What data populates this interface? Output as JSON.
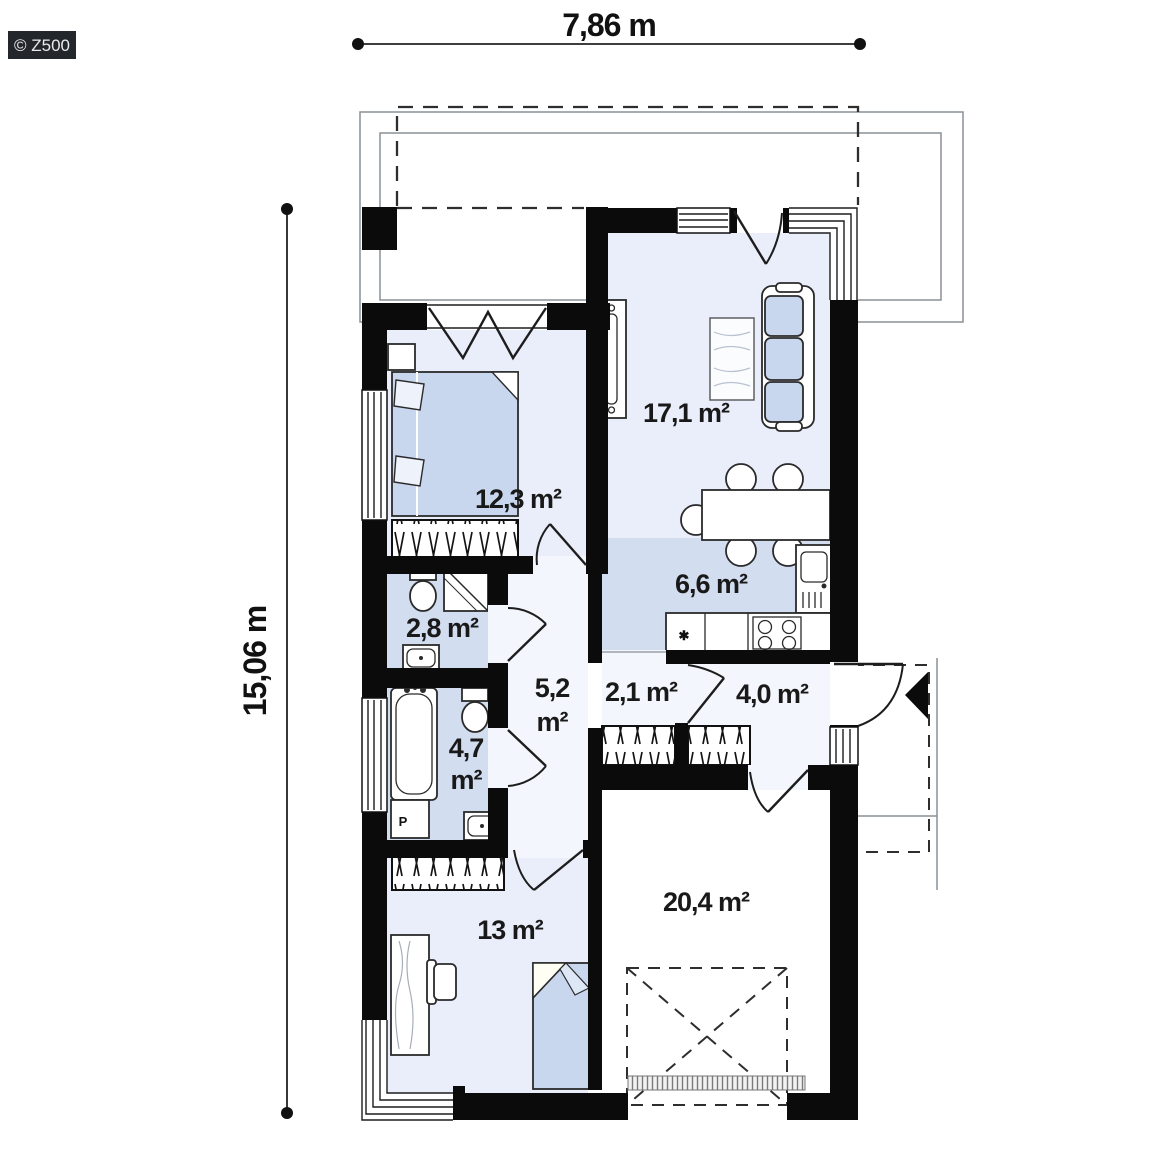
{
  "logo": {
    "text": "© Z500"
  },
  "dimensions": {
    "width": "7,86 m",
    "height": "15,06 m"
  },
  "rooms": {
    "living": "17,1 m²",
    "bedroom_main": "12,3 m²",
    "wc": "2,8 m²",
    "hall": {
      "value": "5,2",
      "unit": "m²"
    },
    "closet": "2,1 m²",
    "entry": "4,0 m²",
    "bathroom": {
      "value": "4,7",
      "unit": "m²"
    },
    "kitchen": "6,6 m²",
    "bedroom_second": "13 m²",
    "garage": "20,4 m²"
  },
  "fixtures": {
    "washer_label": "P",
    "counter_symbol": "✱"
  },
  "colors": {
    "wall": "#0b0b0c",
    "floor_light": "#e9eefa",
    "floor_medium": "#d2ddf0",
    "floor_pale": "#f3f6fc",
    "furniture_blue": "#c8d6ee",
    "outline_gray": "#8a9097",
    "label": "#191919",
    "logo_bg": "#23262b"
  }
}
